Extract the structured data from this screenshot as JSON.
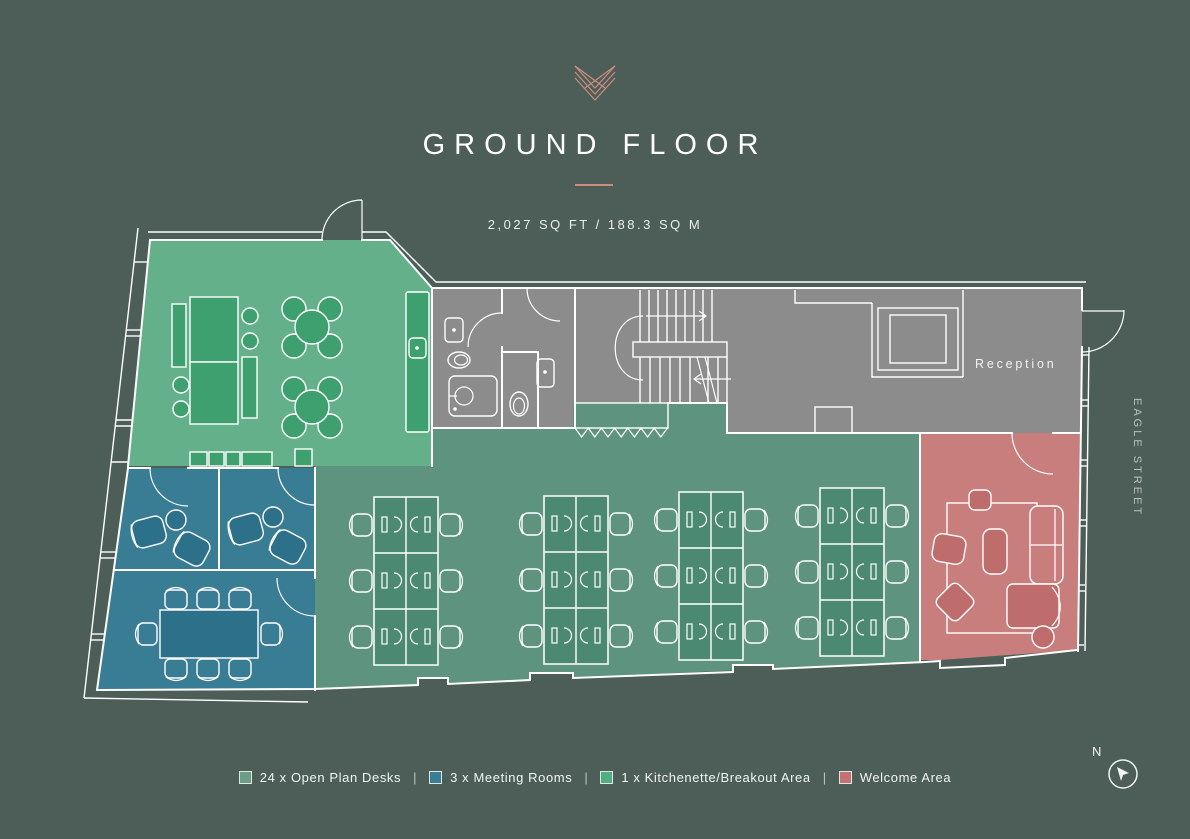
{
  "header": {
    "title": "GROUND FLOOR",
    "area_label": "2,027 SQ FT / 188.3 SQ M"
  },
  "plan": {
    "reception_label": "Reception",
    "street_label": "EAGLE STREET",
    "compass_north_label": "N"
  },
  "legend": {
    "separator": "|",
    "items": [
      {
        "label": "24 x Open Plan Desks",
        "swatch": "#6B9E88"
      },
      {
        "label": "3 x Meeting Rooms",
        "swatch": "#3A7E95"
      },
      {
        "label": "1 x Kitchenette/Breakout Area",
        "swatch": "#54AD82"
      },
      {
        "label": "Welcome Area",
        "swatch": "#C57173"
      }
    ]
  },
  "colors": {
    "bg": "#4C5E57",
    "wall": "#FFFFFF",
    "accent": "#CC8D80",
    "corridor": "#8C8C8C",
    "kitchen": "#63B08A",
    "kitchen_dark": "#3FA06F",
    "desks": "#5E947F",
    "desks_dark": "#4C8972",
    "meeting": "#397D94",
    "meeting_dark": "#2D7089",
    "welcome": "#C87E7D",
    "welcome_dark": "#BF6C6C",
    "street_text": "#B7C2BB"
  }
}
